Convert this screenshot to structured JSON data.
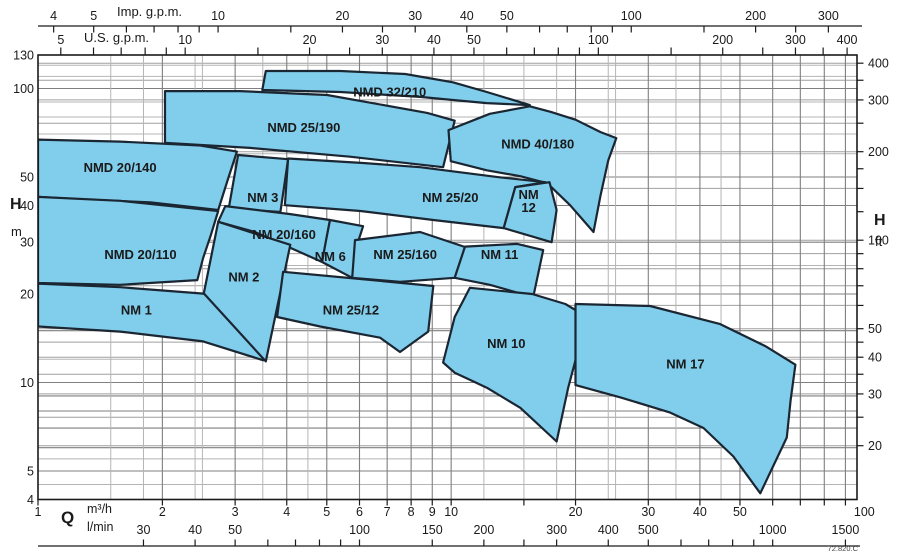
{
  "labels": {
    "imp_axis": "Imp. g.p.m.",
    "us_axis": "U.S. g.p.m.",
    "head_symbol_left": "H",
    "head_unit_left": "m",
    "head_symbol_right": "H",
    "head_unit_right": "ft",
    "flow_symbol": "Q",
    "flow_unit_row1": "m³/h",
    "flow_unit_row2": "l/min",
    "doc_ref": "72.820.C"
  },
  "chart_data": {
    "type": "area",
    "title": "Pump selection coverage chart (NM / NMD series), flow vs head, log-log",
    "axes": {
      "flow_m3h": {
        "min": 1,
        "max": 96,
        "ticks": [
          1,
          2,
          3,
          4,
          5,
          6,
          7,
          8,
          9,
          10,
          15,
          20,
          30,
          40,
          50,
          60,
          70,
          80,
          90
        ],
        "labeled": [
          1,
          2,
          3,
          4,
          5,
          6,
          7,
          8,
          9,
          10,
          20,
          30,
          40,
          50,
          100
        ]
      },
      "flow_lmin": {
        "ticks": [
          30,
          40,
          50,
          60,
          70,
          80,
          90,
          100,
          150,
          200,
          250,
          300,
          400,
          500,
          600,
          700,
          800,
          900,
          1000,
          1500
        ],
        "labeled": [
          30,
          40,
          50,
          100,
          150,
          200,
          300,
          400,
          500,
          1000,
          1500
        ]
      },
      "imp_gpm": {
        "ticks": [
          4,
          5,
          6,
          7,
          8,
          9,
          10,
          15,
          20,
          25,
          30,
          40,
          50,
          60,
          70,
          80,
          90,
          100,
          150,
          200,
          250,
          300
        ],
        "labeled": [
          4,
          5,
          10,
          20,
          30,
          40,
          50,
          100,
          200,
          300
        ]
      },
      "us_gpm": {
        "ticks": [
          5,
          6,
          7,
          8,
          9,
          10,
          15,
          20,
          25,
          30,
          40,
          50,
          60,
          70,
          80,
          90,
          100,
          150,
          200,
          250,
          300,
          350,
          400
        ],
        "labeled": [
          5,
          10,
          20,
          30,
          40,
          50,
          100,
          200,
          300,
          400
        ]
      },
      "head_m": {
        "min": 4,
        "max": 130,
        "labeled": [
          4,
          5,
          10,
          20,
          30,
          40,
          50,
          100,
          130
        ]
      },
      "head_ft": {
        "ticks": [
          20,
          25,
          30,
          35,
          40,
          45,
          50,
          60,
          70,
          80,
          90,
          100,
          125,
          150,
          175,
          200,
          250,
          300,
          350,
          400
        ],
        "labeled": [
          20,
          30,
          40,
          50,
          100,
          200,
          300,
          400
        ]
      }
    },
    "grid": {
      "x_major": [
        1,
        2,
        3,
        4,
        5,
        6,
        7,
        8,
        9,
        10,
        20,
        30,
        40,
        50,
        60,
        70,
        80,
        90
      ],
      "x_minor": [
        1.5,
        1.8,
        2.4,
        2.5,
        3.5,
        4.5,
        12,
        15,
        18,
        24,
        25,
        35,
        45
      ],
      "y_major_m": [
        5,
        6,
        7,
        8,
        9,
        10,
        15,
        20,
        30,
        40,
        50,
        100
      ],
      "y_minor_m": [
        4.5,
        5.5,
        12,
        25,
        60,
        70,
        80,
        90,
        110,
        120
      ],
      "y_ft_lines": [
        20,
        25,
        30,
        35,
        40,
        45,
        50,
        60,
        70,
        80,
        90,
        100,
        150,
        200,
        250,
        300,
        350,
        400
      ]
    },
    "unit_conversions": {
      "imp_gpm_to_m3h": 0.2728,
      "us_gpm_to_m3h": 0.2271,
      "lmin_to_m3h": 0.06,
      "ft_to_m": 0.3048
    },
    "regions": [
      {
        "name": "NMD 20/140",
        "label": "NMD 20/140",
        "label_at": [
          1.58,
          53.6
        ],
        "points": [
          [
            1,
            67
          ],
          [
            1.58,
            66
          ],
          [
            2.47,
            64
          ],
          [
            3.03,
            61
          ],
          [
            2.88,
            49
          ],
          [
            2.73,
            38.6
          ],
          [
            1.87,
            41
          ],
          [
            1.26,
            42
          ],
          [
            1,
            42.8
          ]
        ]
      },
      {
        "name": "NMD 20/110",
        "label": "NMD 20/110",
        "label_at": [
          1.77,
          27.1
        ],
        "points": [
          [
            1,
            42.8
          ],
          [
            1.58,
            41.5
          ],
          [
            2.73,
            38.3
          ],
          [
            2.62,
            31.7
          ],
          [
            2.51,
            26.5
          ],
          [
            2.43,
            22.3
          ],
          [
            1.58,
            21.5
          ],
          [
            1,
            21.8
          ]
        ]
      },
      {
        "name": "NM 1",
        "label": "NM 1",
        "label_at": [
          1.73,
          17.6
        ],
        "points": [
          [
            1,
            21.7
          ],
          [
            1.58,
            21.1
          ],
          [
            2.47,
            20.1
          ],
          [
            3.56,
            19.1
          ],
          [
            3.51,
            11.9
          ],
          [
            2.51,
            13.8
          ],
          [
            1.58,
            14.9
          ],
          [
            1,
            15.5
          ]
        ]
      },
      {
        "name": "NMD 25/190",
        "label": "NMD 25/190",
        "label_at": [
          4.4,
          73.4
        ],
        "points": [
          [
            2.03,
            98
          ],
          [
            3.08,
            98
          ],
          [
            5.01,
            95
          ],
          [
            8.75,
            82.6
          ],
          [
            10.2,
            77.7
          ],
          [
            9.56,
            54
          ],
          [
            5.69,
            58.6
          ],
          [
            3.26,
            62.8
          ],
          [
            2.03,
            65.3
          ]
        ]
      },
      {
        "name": "NMD 32/210",
        "label": "NMD 32/210",
        "label_at": [
          7.1,
          97
        ],
        "points": [
          [
            3.56,
            114.7
          ],
          [
            5.39,
            114.7
          ],
          [
            7.74,
            112
          ],
          [
            10.1,
            105
          ],
          [
            12.2,
            97.3
          ],
          [
            15.5,
            87.8
          ],
          [
            12.2,
            89.2
          ],
          [
            10.1,
            91.4
          ],
          [
            8.41,
            93.6
          ],
          [
            5.39,
            97.3
          ],
          [
            3.49,
            98.8
          ]
        ]
      },
      {
        "name": "NMD 40/180",
        "label": "NMD 40/180",
        "label_at": [
          16.2,
          64.5
        ],
        "points": [
          [
            9.85,
            72.2
          ],
          [
            12.4,
            82
          ],
          [
            15.5,
            87
          ],
          [
            17.4,
            83.3
          ],
          [
            20,
            78.3
          ],
          [
            23,
            71.1
          ],
          [
            25.1,
            67.8
          ],
          [
            24,
            57
          ],
          [
            23,
            43.4
          ],
          [
            22.1,
            32.5
          ],
          [
            19.4,
            40.1
          ],
          [
            17.1,
            47.6
          ],
          [
            14.7,
            50.3
          ],
          [
            12.2,
            52.7
          ],
          [
            9.98,
            56.6
          ]
        ]
      },
      {
        "name": "NM 3",
        "label": "NM 3",
        "label_at": [
          3.5,
          42.4
        ],
        "points": [
          [
            3.05,
            59.4
          ],
          [
            4.03,
            57.5
          ],
          [
            3.86,
            38
          ],
          [
            3.26,
            38.6
          ],
          [
            2.87,
            36.5
          ]
        ]
      },
      {
        "name": "NM 25/20",
        "label": "NM 25/20",
        "label_at": [
          9.95,
          42.4
        ],
        "points": [
          [
            4.03,
            57.8
          ],
          [
            6.12,
            55.8
          ],
          [
            8.41,
            54
          ],
          [
            13.1,
            49.9
          ],
          [
            16.9,
            48
          ],
          [
            14.3,
            46.2
          ],
          [
            13.4,
            33.5
          ],
          [
            9.05,
            35.7
          ],
          [
            6.03,
            38.3
          ],
          [
            3.96,
            40.1
          ]
        ]
      },
      {
        "name": "NM 12",
        "label": "NM 12",
        "label_lines": [
          "NM",
          "12"
        ],
        "label_at": [
          15.4,
          41.5
        ],
        "points": [
          [
            14.3,
            46.2
          ],
          [
            17.3,
            48
          ],
          [
            18,
            38.6
          ],
          [
            17.5,
            30
          ],
          [
            13.4,
            33.5
          ]
        ]
      },
      {
        "name": "NM 20/160",
        "label": "NM 20/160",
        "label_at": [
          3.94,
          31.7
        ],
        "points": [
          [
            2.84,
            39.8
          ],
          [
            4.08,
            37.4
          ],
          [
            5.09,
            35.7
          ],
          [
            4.87,
            25.7
          ],
          [
            3.35,
            32.5
          ],
          [
            2.73,
            35.2
          ]
        ]
      },
      {
        "name": "NM 6",
        "label": "NM 6",
        "label_at": [
          5.1,
          26.7
        ],
        "points": [
          [
            5.09,
            35.7
          ],
          [
            6.12,
            34
          ],
          [
            5.92,
            29.4
          ],
          [
            5.76,
            22.7
          ],
          [
            4.87,
            25.7
          ],
          [
            4.98,
            30.5
          ]
        ]
      },
      {
        "name": "NM 25/160",
        "label": "NM 25/160",
        "label_at": [
          7.74,
          27.1
        ],
        "points": [
          [
            5.85,
            30.5
          ],
          [
            8.41,
            32.5
          ],
          [
            10.8,
            28.9
          ],
          [
            10.2,
            22.7
          ],
          [
            7.52,
            22
          ],
          [
            5.76,
            22.7
          ]
        ]
      },
      {
        "name": "NM 11",
        "label": "NM 11",
        "label_at": [
          13.1,
          27.1
        ],
        "points": [
          [
            10.8,
            29
          ],
          [
            14.45,
            29.6
          ],
          [
            16.7,
            28.2
          ],
          [
            15.8,
            19.5
          ],
          [
            12.4,
            21.5
          ],
          [
            10.2,
            22.7
          ]
        ]
      },
      {
        "name": "NM 2",
        "label": "NM 2",
        "label_at": [
          3.15,
          22.8
        ],
        "points": [
          [
            2.73,
            35.2
          ],
          [
            4.08,
            29.4
          ],
          [
            3.56,
            11.8
          ],
          [
            2.52,
            20.1
          ]
        ]
      },
      {
        "name": "NM 25/12",
        "label": "NM 25/12",
        "label_at": [
          5.72,
          17.6
        ],
        "points": [
          [
            3.92,
            23.8
          ],
          [
            6.03,
            22.5
          ],
          [
            9.05,
            21.3
          ],
          [
            8.8,
            14.9
          ],
          [
            7.52,
            12.7
          ],
          [
            6.73,
            14.2
          ],
          [
            4.82,
            15.5
          ],
          [
            3.79,
            16.7
          ]
        ]
      },
      {
        "name": "NM 10",
        "label": "NM 10",
        "label_at": [
          13.6,
          13.5
        ],
        "points": [
          [
            11.1,
            21
          ],
          [
            15.7,
            20
          ],
          [
            18.9,
            18.5
          ],
          [
            21.5,
            16.6
          ],
          [
            20.3,
            12.9
          ],
          [
            19.2,
            9.6
          ],
          [
            18,
            6.3
          ],
          [
            14.7,
            8.2
          ],
          [
            12.2,
            9.6
          ],
          [
            10.2,
            10.8
          ],
          [
            9.56,
            11.7
          ],
          [
            10.2,
            16.7
          ]
        ]
      },
      {
        "name": "NM 17",
        "label": "NM 17",
        "label_at": [
          36.9,
          11.5
        ],
        "points": [
          [
            20,
            18.5
          ],
          [
            30.3,
            18.2
          ],
          [
            44.8,
            15.8
          ],
          [
            57.6,
            13.3
          ],
          [
            68.1,
            11.5
          ],
          [
            66.3,
            8.7
          ],
          [
            64.9,
            6.5
          ],
          [
            56,
            4.2
          ],
          [
            48.2,
            5.6
          ],
          [
            40.8,
            7
          ],
          [
            33.9,
            7.9
          ],
          [
            25.7,
            8.9
          ],
          [
            20,
            9.8
          ]
        ]
      }
    ],
    "colors": {
      "region_fill": "#81cdec",
      "region_stroke": "#1a2632",
      "grid_major": "#7f7f7f",
      "grid_minor": "#b5b5b5",
      "grid_ft": "#9f9f9f",
      "axis": "#1a1a1a",
      "background": "#ffffff"
    },
    "legend": "none",
    "doc_ref": "72.820.C"
  }
}
